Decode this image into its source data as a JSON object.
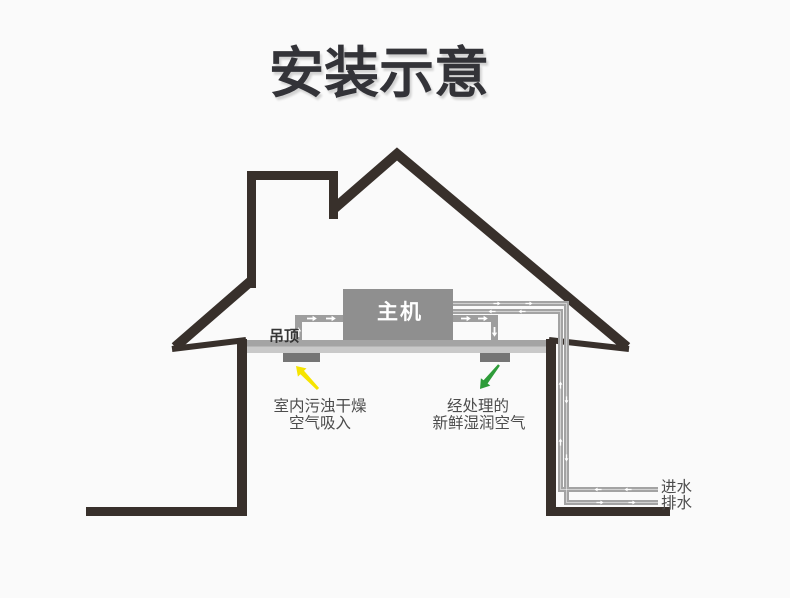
{
  "title": "安装示意",
  "diagram": {
    "unit_label": "主机",
    "ceiling_label": "吊顶",
    "intake": {
      "line1": "室内污浊干燥",
      "line2": "空气吸入"
    },
    "fresh_air": {
      "line1": "经处理的",
      "line2": "新鲜湿润空气"
    },
    "water_inlet_label": "进水",
    "drain_label": "排水"
  },
  "colors": {
    "background": "#fafafa",
    "outline": "#38302b",
    "ceiling_top": "#a4a4a4",
    "ceiling_bottom": "#c9c9c9",
    "vent": "#757575",
    "unit_fill": "#8f8f8f",
    "duct": "#9e9e9e",
    "pipe": "#a3a3a3",
    "intake_arrow": "#f6e400",
    "fresh_arrow": "#2e9c39",
    "label_text": "#4c4c4c",
    "title_text": "#333338"
  }
}
